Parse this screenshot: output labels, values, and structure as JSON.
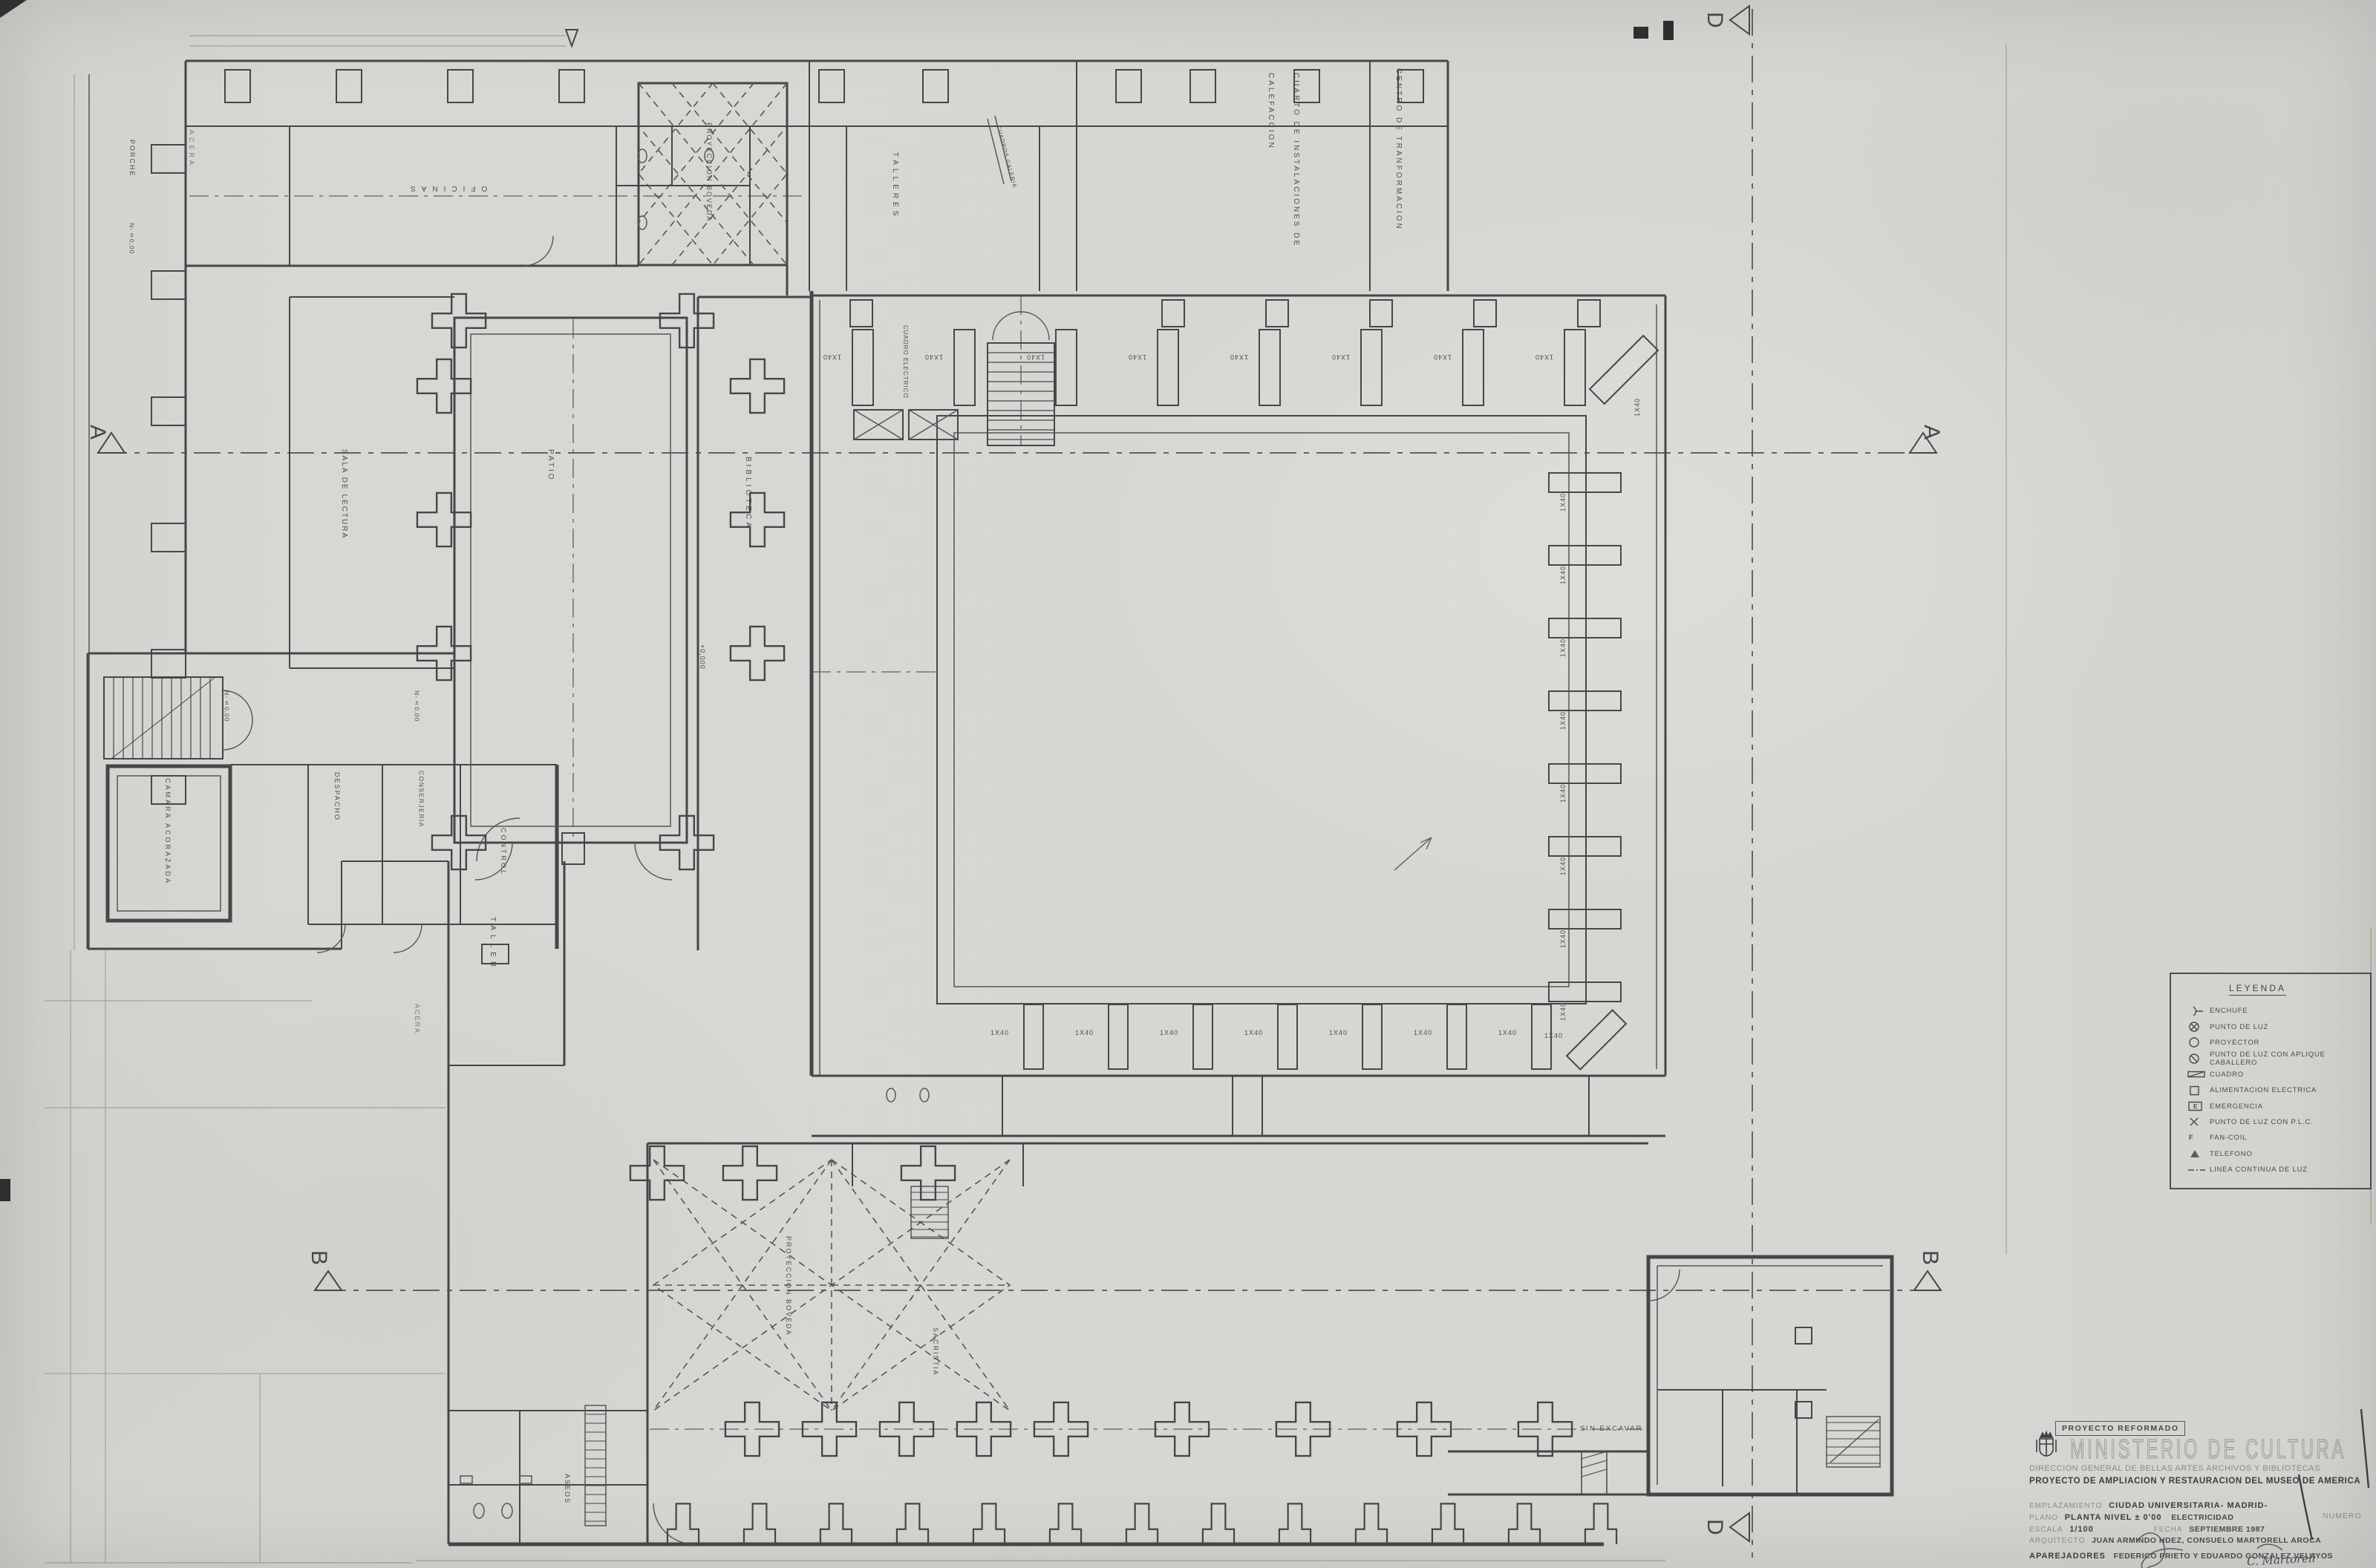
{
  "document": {
    "kind": "architectural electrical floor plan (scanned blueprint)",
    "paper_color": "#d7d6d2",
    "ink_color": "#46464a"
  },
  "section_markers": {
    "a": "A",
    "b": "B",
    "d": "D"
  },
  "rooms": {
    "acera_top": "ACERA",
    "acera_bottom": "ACERA",
    "porche": "PORCHE",
    "porche_level": "N-±0,00",
    "oficinas": "OFICINAS",
    "proyeccion_boveda": "PROYECCION BOVEDA",
    "talleres": "TALLERES",
    "cuadros_galeria": "CUADROS GALERIA",
    "cuadro_electrico": "CUADRO ELECTRICO",
    "calefaccion": "CUARTO DE INSTALACIONES DE CALEFACCION",
    "centro_transformacion": "CENTRO DE TRANFORMACION",
    "sala_lectura": "SALA DE LECTURA",
    "patio": "PATIO",
    "biblioteca": "BIBLIOTECA",
    "cota": "+0,000",
    "nivel_a": "N-±0,00",
    "nivel_b": "N-±0,00",
    "camara": "CAMARA ACORAZADA",
    "despacho": "DESPACHO",
    "conserjeria": "CONSERJERIA",
    "control": "CONTROL",
    "taller": "TALLER",
    "proyeccion_boveda_2": "PROYECCION BOVEDA",
    "sacristia": "SACRISTIA",
    "aseos": "ASEOS",
    "sin_excavar": "SIN EXCAVAR"
  },
  "hall": {
    "fixture_label": "1X40"
  },
  "legend": {
    "title": "LEYENDA",
    "items": [
      {
        "symbol": "enchufe-icon",
        "label": "ENCHUFE"
      },
      {
        "symbol": "punto-de-luz-icon",
        "label": "PUNTO DE LUZ"
      },
      {
        "symbol": "proyector-icon",
        "label": "PROYECTOR"
      },
      {
        "symbol": "aplique-caballero-icon",
        "label": "PUNTO DE LUZ CON APLIQUE CABALLERO"
      },
      {
        "symbol": "cuadro-icon",
        "label": "CUADRO"
      },
      {
        "symbol": "alimentacion-icon",
        "label": "ALIMENTACION ELECTRICA"
      },
      {
        "symbol": "emergencia-icon",
        "label": "EMERGENCIA",
        "letter": "E"
      },
      {
        "symbol": "punto-luz-plc-icon",
        "label": "PUNTO DE LUZ CON P.L.C."
      },
      {
        "symbol": "fan-coil-letter-icon",
        "label": "FAN-COIL",
        "letter": "F"
      },
      {
        "symbol": "telefono-icon",
        "label": "TELEFONO"
      },
      {
        "symbol": "linea-continua-icon",
        "label": "LINEA CONTINUA DE LUZ"
      }
    ]
  },
  "title_block": {
    "stamp": "PROYECTO REFORMADO",
    "ministry": "MINISTERIO DE CULTURA",
    "direccion": "DIRECCION GENERAL DE BELLAS ARTES ARCHIVOS Y BIBLIOTECAS",
    "project": "PROYECTO DE AMPLIACION Y RESTAURACION DEL MUSEO DE AMERICA",
    "emplazamiento_label": "EMPLAZAMIENTO",
    "emplazamiento": "CIUDAD UNIVERSITARIA- MADRID-",
    "plano_label": "PLANO",
    "plano": "PLANTA NIVEL ± 0'00",
    "plano_2": "ELECTRICIDAD",
    "escala_label": "ESCALA",
    "escala": "1/100",
    "fecha_label": "FECHA",
    "fecha": "SEPTIEMBRE 1987",
    "numero_label": "NUMERO",
    "arquitecto_label": "ARQUITECTO",
    "arquitecto": "JUAN ARMINDO HDEZ, CONSUELO MARTORELL AROCA",
    "aparejadores_label": "APAREJADORES",
    "aparejadores": "FEDERICO PRIETO Y EDUARDO GONZALEZ VELAYOS",
    "signature": "C. Martorell"
  }
}
